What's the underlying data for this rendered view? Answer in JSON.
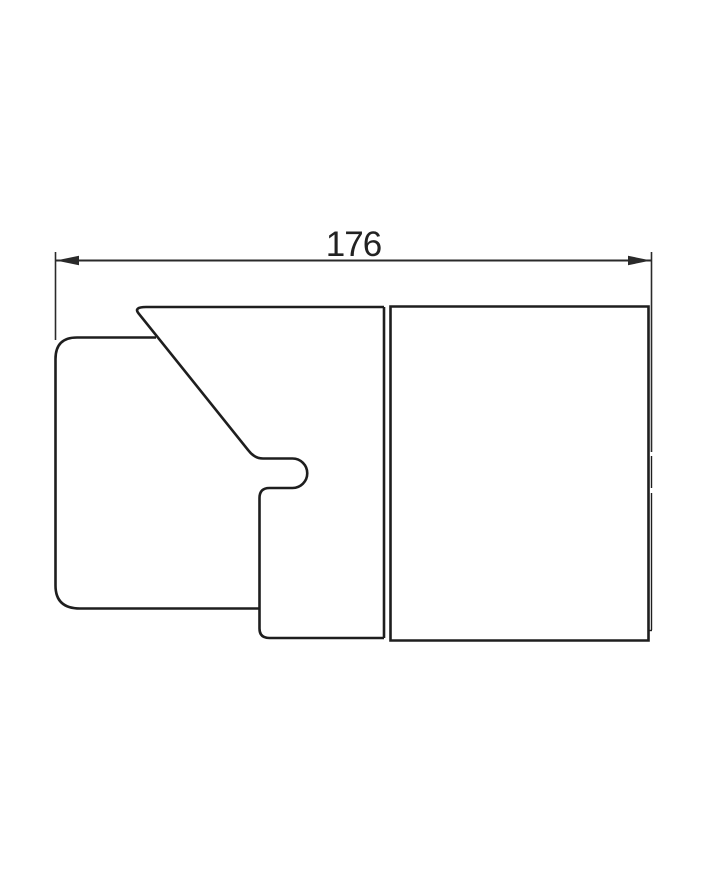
{
  "drawing": {
    "type": "technical-drawing",
    "dimension_label": "176",
    "colors": {
      "line": "#1e1e1e",
      "dimension": "#2a2a2a",
      "background": "#ffffff"
    }
  }
}
